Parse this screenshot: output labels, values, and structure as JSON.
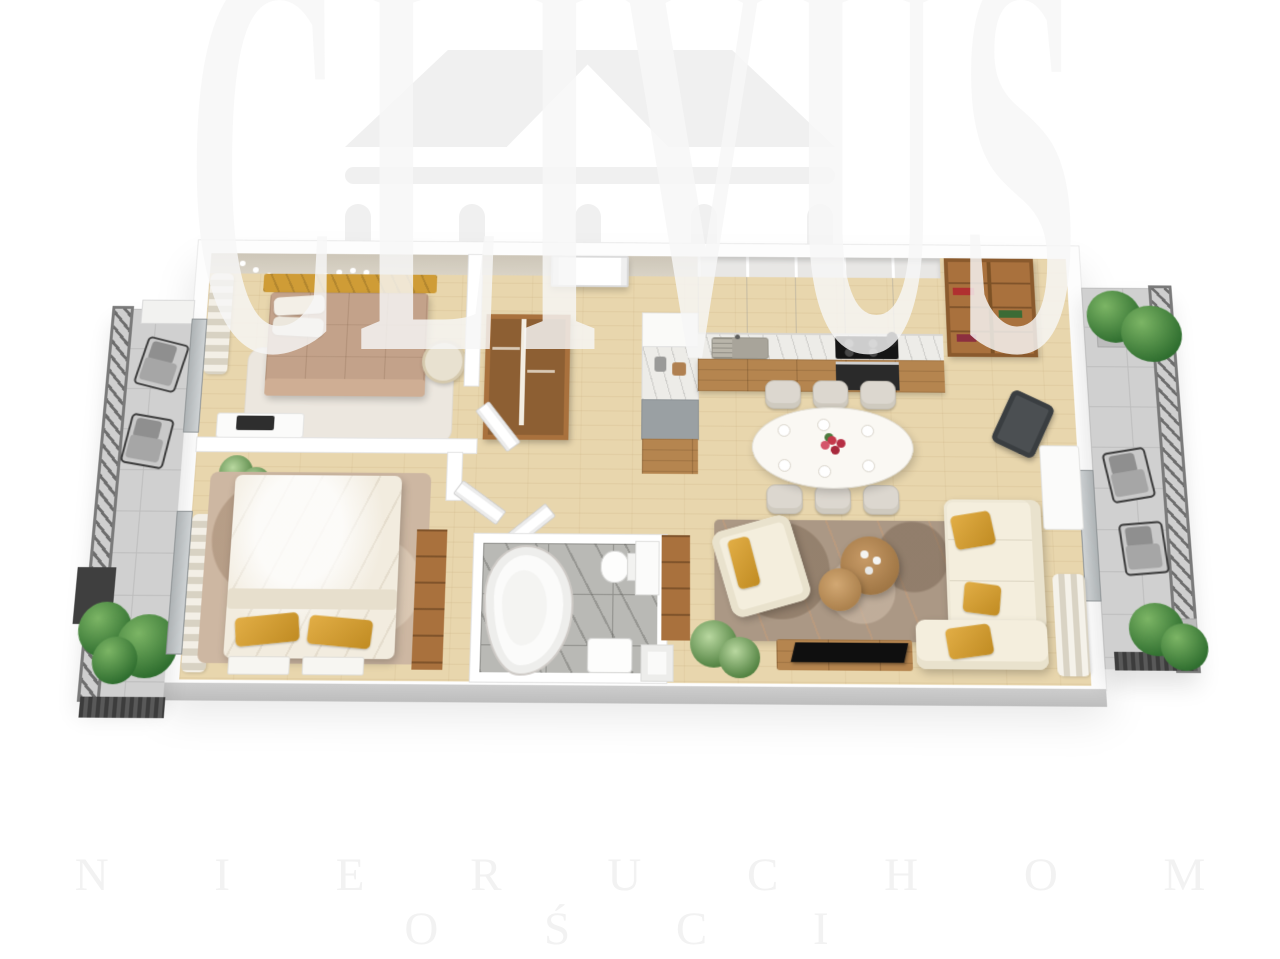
{
  "watermark": {
    "brand": "CLIVUS",
    "subtitle": "N I E R U C H O M O Ś C I",
    "logo_icon": "classical-house-pediment-with-columns"
  },
  "palette": {
    "watermark_gray": "#f0f0f0",
    "wall_beige": "#cdc6b8",
    "wall_face_gray": "#c7c7c7",
    "floor_wood": "#e8d6ad",
    "lower_wood": "#b5854f",
    "shelf_wood": "#a9713d",
    "accent_mustard": "#cf9c36",
    "duvet_tan": "#c3a28a",
    "sofa_cream": "#f4eedd",
    "rug_living": "#ab9885",
    "rug_bedroom2": "#cdb7a2",
    "balcony_tile": "#d0d0d0",
    "railing_gray": "#7a7a7a",
    "marble_tile": "#b9b9b5",
    "plant_green": "#3c7d3a",
    "hob_black": "#151515"
  },
  "floorplan": {
    "type": "apartment-3d-floor-plan",
    "rooms": [
      {
        "name": "bedroom-1",
        "furniture": [
          "double-bed-mustard-headboard",
          "string-lights",
          "white-rug",
          "rattan-chair",
          "desk-with-laptop",
          "curtain",
          "wardrobe"
        ]
      },
      {
        "name": "bedroom-2",
        "furniture": [
          "double-bed-white-duvet",
          "two-mustard-pillows",
          "wood-shelf-unit",
          "bench",
          "rug",
          "wavy-curtain",
          "potted-plant"
        ]
      },
      {
        "name": "bathroom",
        "furniture": [
          "corner-bathtub",
          "toilet",
          "washbasin",
          "tall-cabinet",
          "marble-floor"
        ]
      },
      {
        "name": "entry-hall",
        "furniture": [
          "entrance-door",
          "double-wardrobe",
          "tall-column-cabinet"
        ]
      },
      {
        "name": "kitchen",
        "furniture": [
          "upper-cabinets",
          "open-cubbies",
          "marble-counter",
          "sink",
          "induction-hob",
          "oven",
          "wood-drawers",
          "bookshelf-with-books"
        ]
      },
      {
        "name": "dining-area",
        "furniture": [
          "oval-white-table",
          "six-upholstered-chairs",
          "red-tulip-vase",
          "table-settings"
        ]
      },
      {
        "name": "living-room",
        "furniture": [
          "cream-corner-sofa",
          "mustard-pillows",
          "cream-armchair",
          "nesting-coffee-tables",
          "patterned-rug",
          "tv-console",
          "flat-tv",
          "potted-plant",
          "tall-wood-cabinet",
          "desk",
          "office-chair",
          "wavy-curtain"
        ]
      },
      {
        "name": "balcony-left",
        "furniture": [
          "metal-slat-railing",
          "stone-tiles",
          "two-lounge-chairs",
          "green-bushes",
          "dark-planter",
          "white-planter"
        ]
      },
      {
        "name": "balcony-right",
        "furniture": [
          "metal-slat-railing",
          "stone-tiles",
          "two-lounge-chairs",
          "green-bushes",
          "gray-planters"
        ]
      }
    ]
  }
}
